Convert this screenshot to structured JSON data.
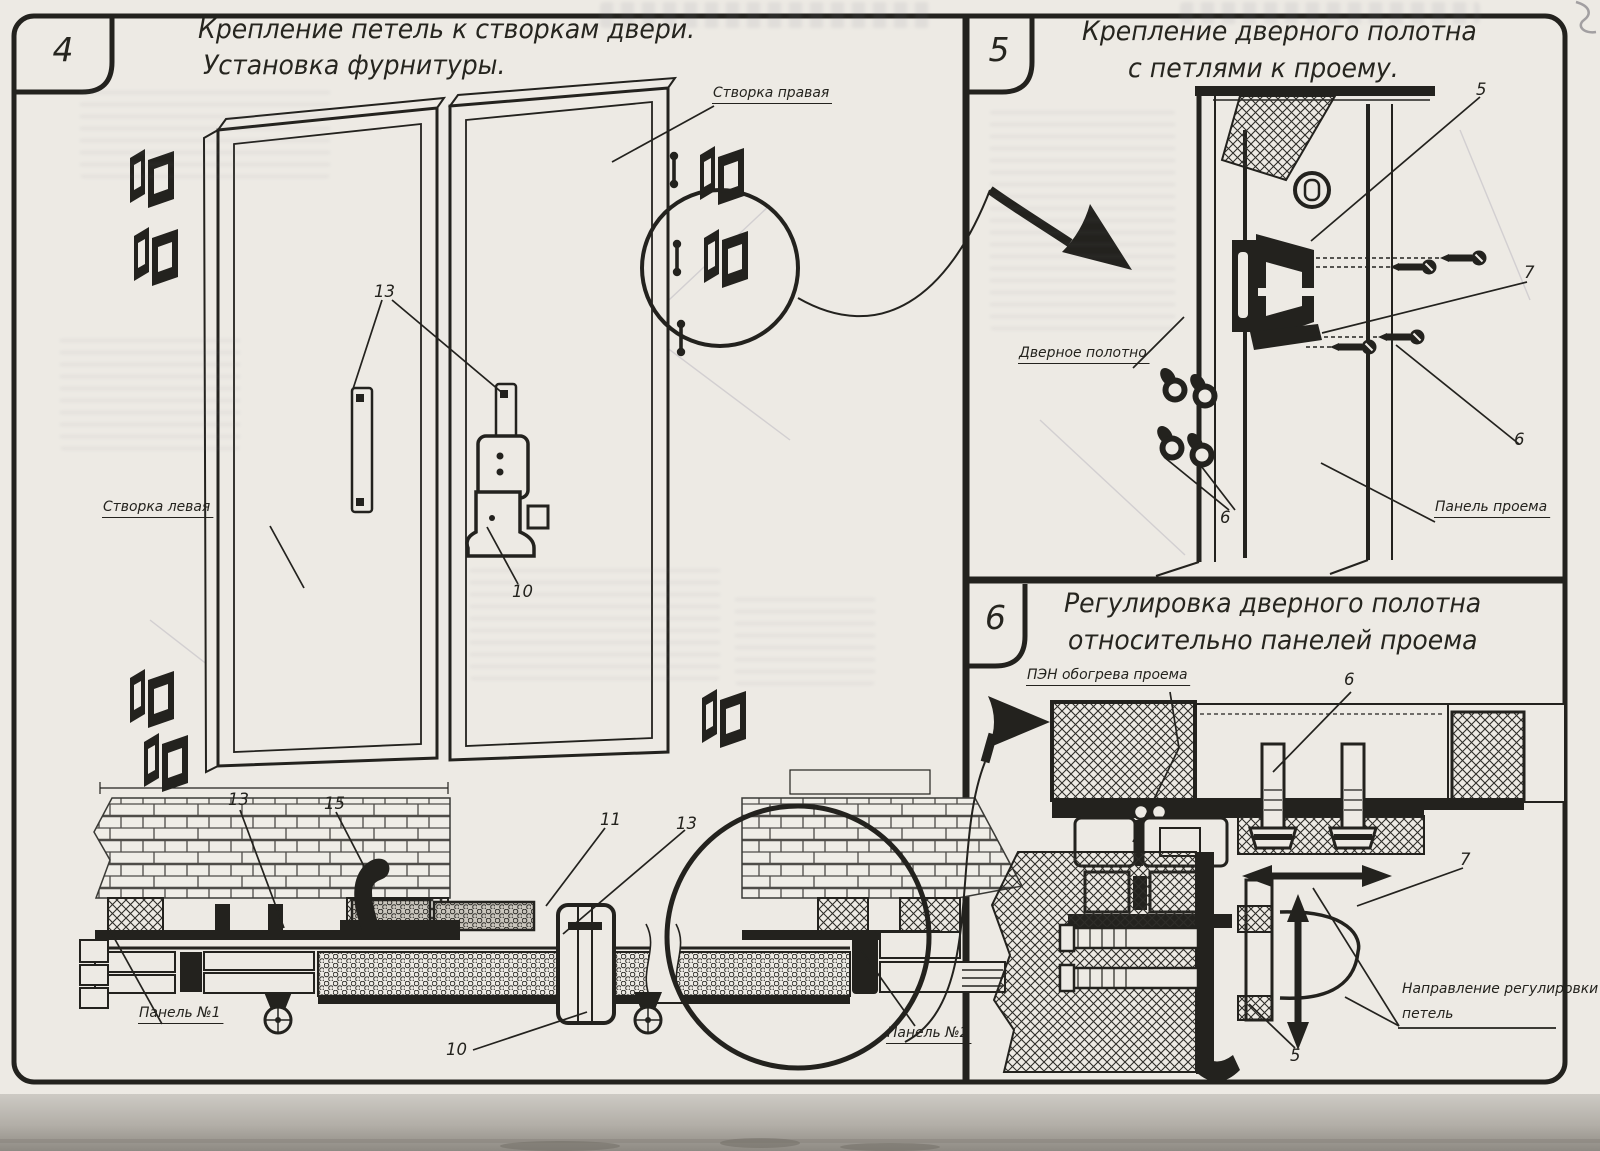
{
  "page": {
    "ink": "#23221e",
    "paper": "#edeae4"
  },
  "panel4": {
    "number": "4",
    "title_line1": "Крепление петель к створкам двери.",
    "title_line2": "Установка фурнитуры.",
    "labels": {
      "right_leaf": "Створка правая",
      "left_leaf": "Створка левая",
      "panel_no1": "Панель №1",
      "panel_no2": "Панель №2"
    },
    "callouts": {
      "hinge_plates_13": "13",
      "latch_10": "10",
      "section_13_left": "13",
      "handle_15": "15",
      "item_11": "11",
      "section_13_right": "13",
      "section_10": "10"
    }
  },
  "panel5": {
    "number": "5",
    "title_line1": "Крепление дверного полотна",
    "title_line2": "с петлями к проему.",
    "labels": {
      "door_leaf": "Дверное полотно",
      "opening_panel": "Панель проема"
    },
    "callouts": {
      "hinge_5": "5",
      "item_7": "7",
      "screws_6": "6",
      "nuts_6": "6"
    }
  },
  "panel6": {
    "number": "6",
    "title_line1": "Регулировка дверного полотна",
    "title_line2": "относительно панелей проема",
    "labels": {
      "heater": "ПЭН обогрева проема",
      "direction_line1": "Направление регулировки",
      "direction_line2": "петель"
    },
    "callouts": {
      "bolt_6": "6",
      "hinge_7": "7",
      "item_5": "5"
    }
  }
}
